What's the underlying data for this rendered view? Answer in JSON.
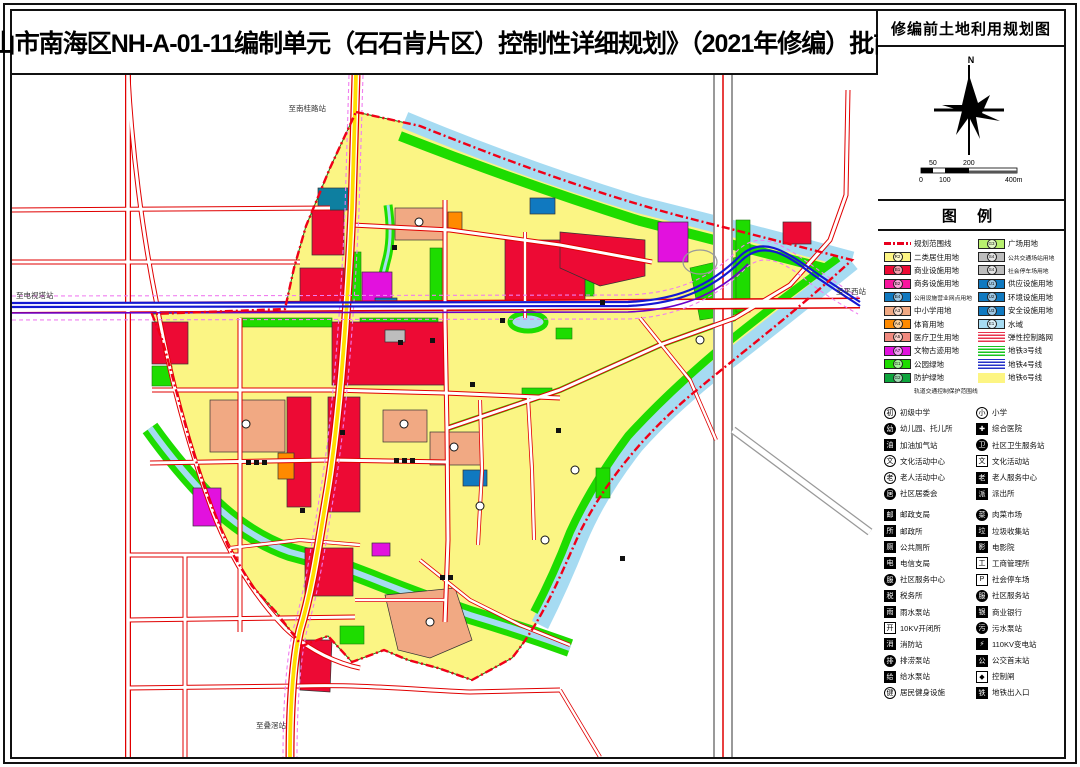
{
  "page": {
    "title": "《佛山市南海区NH-A-01-11编制单元（石石肯片区）控制性详细规划》（2021年修编）批前公示"
  },
  "sidebar": {
    "map_title": "修编前土地利用规划图",
    "compass_label": "N",
    "scale_ticks_top": [
      "50",
      "200"
    ],
    "scale_ticks_bottom": [
      "0",
      "100",
      "400m"
    ],
    "legend_title": "图 例",
    "zoning_left": [
      {
        "label": "规划范围线",
        "type": "line-red-dash"
      },
      {
        "label": "二类居住用地",
        "color": "#fdf583",
        "code": "R2"
      },
      {
        "label": "商业设施用地",
        "color": "#ed0a34",
        "code": "B1"
      },
      {
        "label": "商务设施用地",
        "color": "#f8159e",
        "code": "B2"
      },
      {
        "label": "公用设施营业网点用地",
        "color": "#1079c0",
        "code": "B4",
        "tiny": true
      },
      {
        "label": "中小学用地",
        "color": "#f1a983",
        "code": "A3"
      },
      {
        "label": "体育用地",
        "color": "#ff8a00",
        "code": "A4"
      },
      {
        "label": "医疗卫生用地",
        "color": "#f0897e",
        "code": "A5"
      },
      {
        "label": "文物古迹用地",
        "color": "#e211de",
        "code": "A7"
      },
      {
        "label": "公园绿地",
        "color": "#1edc00",
        "code": "G1"
      },
      {
        "label": "防护绿地",
        "color": "#0da53c",
        "code": "G2"
      },
      {
        "label": "轨道交通控制保护范围线",
        "type": "line-pink-dash",
        "tiny": true
      }
    ],
    "zoning_right": [
      {
        "label": "广场用地",
        "color": "#b8f06e",
        "code": "G3"
      },
      {
        "label": "公共交通场站用地",
        "color": "#bdbdbd",
        "code": "S4",
        "tiny": true
      },
      {
        "label": "社会停车场用地",
        "color": "#bdbdbd",
        "code": "S4",
        "tiny": true
      },
      {
        "label": "供应设施用地",
        "color": "#1079c0",
        "code": "U1"
      },
      {
        "label": "环境设施用地",
        "color": "#1079c0",
        "code": "U2"
      },
      {
        "label": "安全设施用地",
        "color": "#1079c0",
        "code": "U3"
      },
      {
        "label": "水域",
        "color": "#a6dbf2",
        "code": "E1"
      },
      {
        "label": "弹性控制路网",
        "type": "hatch-red"
      },
      {
        "label": "地铁3号线",
        "type": "stripe-green"
      },
      {
        "label": "地铁4号线",
        "type": "stripe-blue"
      },
      {
        "label": "地铁6号线",
        "type": "fill-yellow"
      }
    ],
    "icons_left": [
      {
        "label": "初级中学",
        "glyph": "初",
        "shape": "circle"
      },
      {
        "label": "幼儿园、托儿所",
        "glyph": "幼",
        "shape": "circle-solid"
      },
      {
        "label": "加油加气站",
        "glyph": "油",
        "shape": "square-solid"
      },
      {
        "label": "文化活动中心",
        "glyph": "文",
        "shape": "circle"
      },
      {
        "label": "老人活动中心",
        "glyph": "老",
        "shape": "circle"
      },
      {
        "label": "社区居委会",
        "glyph": "居",
        "shape": "circle-solid"
      },
      {
        "label": "邮政支局",
        "glyph": "邮",
        "shape": "square-solid",
        "gap": true
      },
      {
        "label": "邮政所",
        "glyph": "所",
        "shape": "square-solid"
      },
      {
        "label": "公共厕所",
        "glyph": "厕",
        "shape": "square-solid"
      },
      {
        "label": "电信支局",
        "glyph": "电",
        "shape": "square-solid"
      },
      {
        "label": "社区服务中心",
        "glyph": "服",
        "shape": "circle-solid"
      },
      {
        "label": "税务所",
        "glyph": "税",
        "shape": "square-solid"
      },
      {
        "label": "雨水泵站",
        "glyph": "雨",
        "shape": "square-solid"
      },
      {
        "label": "10KV开闭所",
        "glyph": "开",
        "shape": "square"
      },
      {
        "label": "消防站",
        "glyph": "消",
        "shape": "square-solid"
      },
      {
        "label": "排涝泵站",
        "glyph": "排",
        "shape": "circle-solid"
      },
      {
        "label": "给水泵站",
        "glyph": "给",
        "shape": "square-solid"
      },
      {
        "label": "居民健身设施",
        "glyph": "健",
        "shape": "circle"
      }
    ],
    "icons_right": [
      {
        "label": "小学",
        "glyph": "小",
        "shape": "circle"
      },
      {
        "label": "综合医院",
        "glyph": "✚",
        "shape": "square-solid"
      },
      {
        "label": "社区卫生服务站",
        "glyph": "卫",
        "shape": "circle-solid"
      },
      {
        "label": "文化活动站",
        "glyph": "文",
        "shape": "square"
      },
      {
        "label": "老人服务中心",
        "glyph": "老",
        "shape": "square-solid"
      },
      {
        "label": "派出所",
        "glyph": "派",
        "shape": "square-solid"
      },
      {
        "label": "肉菜市场",
        "glyph": "菜",
        "shape": "circle-solid",
        "gap": true
      },
      {
        "label": "垃圾收集站",
        "glyph": "垃",
        "shape": "square-solid"
      },
      {
        "label": "电影院",
        "glyph": "影",
        "shape": "square-solid"
      },
      {
        "label": "工商管理所",
        "glyph": "工",
        "shape": "square"
      },
      {
        "label": "社会停车场",
        "glyph": "P",
        "shape": "square"
      },
      {
        "label": "社区服务站",
        "glyph": "服",
        "shape": "circle-solid"
      },
      {
        "label": "商业银行",
        "glyph": "银",
        "shape": "square-solid"
      },
      {
        "label": "污水泵站",
        "glyph": "污",
        "shape": "circle-solid"
      },
      {
        "label": "110KV变电站",
        "glyph": "⚡",
        "shape": "square-solid"
      },
      {
        "label": "公交首末站",
        "glyph": "公",
        "shape": "square-solid"
      },
      {
        "label": "控制闸",
        "glyph": "◆",
        "shape": "square"
      },
      {
        "label": "地铁出入口",
        "glyph": "铁",
        "shape": "square-solid"
      }
    ]
  },
  "map": {
    "labels": {
      "north": "至南桂路站",
      "west": "至电视塔站",
      "east": "至平西站",
      "south": "至叠滘站"
    }
  }
}
